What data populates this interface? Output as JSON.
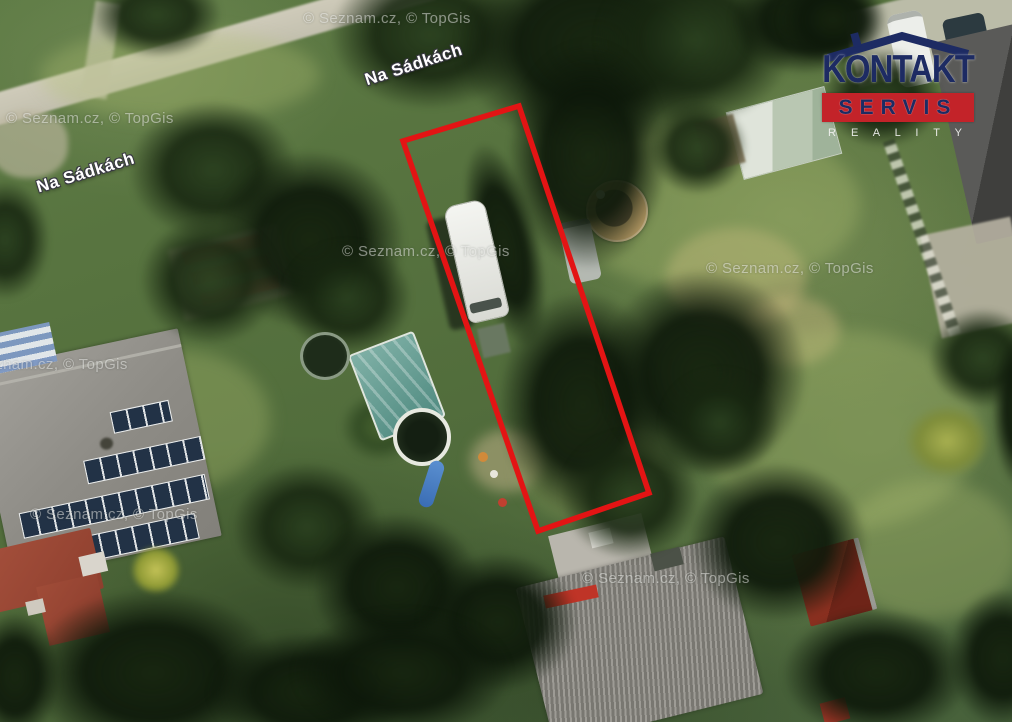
{
  "map": {
    "provider_watermark": "© Seznam.cz, © TopGis",
    "watermarks": [
      {
        "text": "© Seznam.cz, © TopGis",
        "x": 303,
        "y": 10
      },
      {
        "text": "© Seznam.cz, © TopGis",
        "x": 6,
        "y": 110
      },
      {
        "text": "© Seznam.cz, © TopGis",
        "x": 342,
        "y": 243
      },
      {
        "text": "© Seznam.cz, © TopGis",
        "x": 706,
        "y": 260
      },
      {
        "text": "© Seznam.cz, © TopGis",
        "x": -40,
        "y": 356
      },
      {
        "text": "© Seznam.cz, © TopGis",
        "x": 30,
        "y": 506
      },
      {
        "text": "© Seznam.cz, © TopGis",
        "x": 582,
        "y": 570
      }
    ],
    "street_labels": [
      {
        "text": "Na Sádkách",
        "x": 363,
        "y": 55,
        "rot": -18
      },
      {
        "text": "Na Sádkách",
        "x": 35,
        "y": 163,
        "rot": -17
      }
    ]
  },
  "boundary": {
    "points": "403,141 519,106 649,493 538,531",
    "color": "#e31414",
    "stroke_width": "5.5"
  },
  "branding": {
    "logo_line1": "KONTAKT",
    "logo_line2": "SERVIS",
    "logo_line3": "R E A L I T Y",
    "navy": "#1d2b63",
    "red": "#c32329"
  }
}
